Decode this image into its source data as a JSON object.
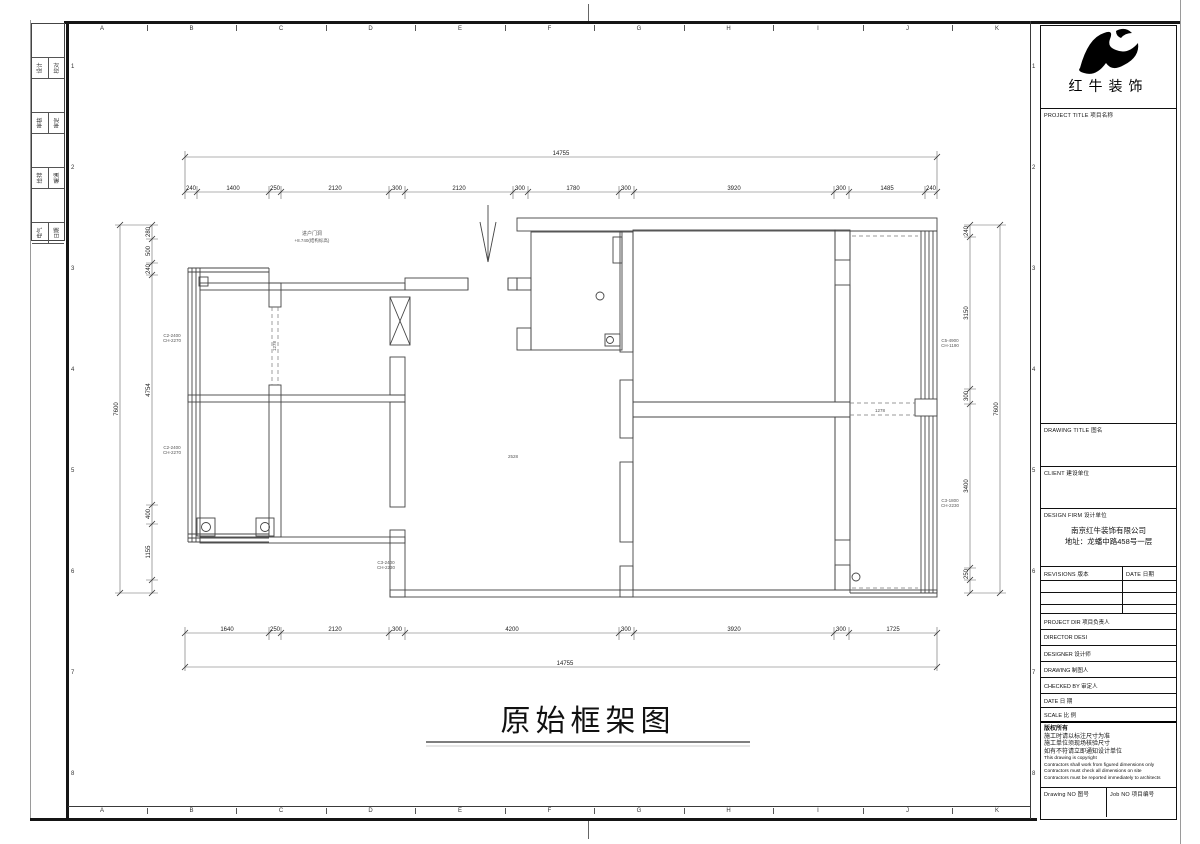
{
  "grid": {
    "letters": [
      "A",
      "B",
      "C",
      "D",
      "E",
      "F",
      "G",
      "H",
      "I",
      "J",
      "K"
    ],
    "numbers": [
      "1",
      "2",
      "3",
      "4",
      "5",
      "6",
      "7",
      "8"
    ]
  },
  "signature_strip": {
    "rows": [
      [
        "设计",
        "校对"
      ],
      [
        "审核",
        "审定"
      ],
      [
        "给排",
        "暖通"
      ],
      [
        "电气",
        "日期"
      ]
    ]
  },
  "title_block": {
    "company": "红牛装饰",
    "project_title_label": "PROJECT TITLE  项目名称",
    "drawing_title_label": "DRAWING TITLE  图名",
    "client_label": "CLIENT  建设单位",
    "design_firm_label": "DESIGN FIRM  设计单位",
    "design_firm_name": "南京红牛装饰有限公司",
    "design_firm_address": "地址：龙蟠中路458号一层",
    "revisions_label": "REVISIONS  版本",
    "date_col_label": "DATE  日期",
    "project_dir_label": "PROJECT DIR   项目负责人",
    "director_label": "DIRECTOR DESI",
    "designer_label": "DESIGNER      设计师",
    "drawing_label": "DRAWING       制图人",
    "checked_by_label": "CHECKED BY    审定人",
    "date_label": "DATE          日  期",
    "scale_label": "SCALE         比  例",
    "copyright_lines": [
      "版权所有",
      "施工时请以标注尺寸为准",
      "施工单位须现场核验尺寸",
      "如有不符请立即通知设计单位",
      "This drawing is copyright",
      "Contractors shall work from figured dimensions only",
      "Contractors must check all dimensions on site",
      "Contractors must be reported immediately to architects"
    ],
    "drawing_no_label": "Drawing NO  图号",
    "job_no_label": "Job NO  项目编号"
  },
  "drawing": {
    "title": "原始框架图",
    "dims": {
      "top_total": "14755",
      "top": [
        "240",
        "1400",
        "250",
        "2120",
        "300",
        "2120",
        "300",
        "1780",
        "300",
        "3920",
        "300",
        "1485",
        "240"
      ],
      "bottom": [
        "1640",
        "250",
        "2120",
        "300",
        "4200",
        "300",
        "3920",
        "300",
        "1725"
      ],
      "bottom_total": "14755",
      "left_total": "7600",
      "left": [
        "280",
        "500",
        "240",
        "4754",
        "400",
        "1155"
      ],
      "right": [
        "240",
        "3150",
        "300",
        "3400",
        "250"
      ],
      "right_total": "7600"
    },
    "annotations": {
      "entry_line1": "进户门洞",
      "entry_line2": "+8.740(结构标高)",
      "room_code": "2528",
      "opening_left": "1278",
      "opening_right": "1278",
      "win_left1_a": "C2-2400",
      "win_left1_b": "CH-2270",
      "win_left2_a": "C2-2400",
      "win_left2_b": "CH-2270",
      "win_bottom_a": "C3-2400",
      "win_bottom_b": "CH-2230",
      "win_right1_a": "C5-4900",
      "win_right1_b": "CH-1190",
      "win_right2_a": "C3-1800",
      "win_right2_b": "CH-2230"
    }
  }
}
